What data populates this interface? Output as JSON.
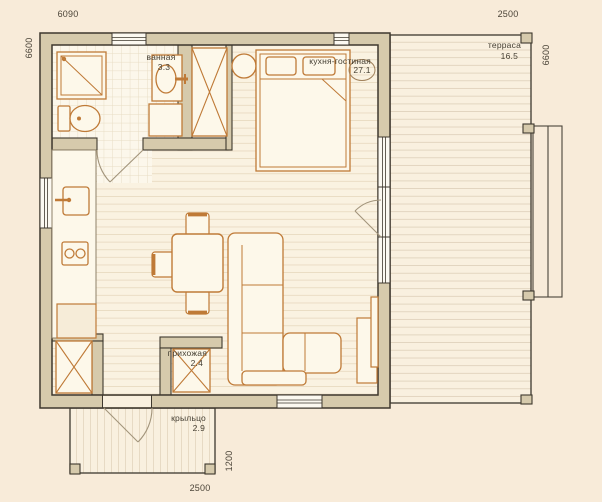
{
  "plan": {
    "title": "studio-house-floor-plan",
    "dimensions": {
      "top": "6090",
      "top_right": "2500",
      "left": "6600",
      "right": "6600",
      "bottom": "2500",
      "porch_side": "1200"
    },
    "rooms": {
      "bathroom": {
        "name": "ванная",
        "area": "3.3"
      },
      "kitchen_living": {
        "name": "кухня-гостиная",
        "area": "27.1"
      },
      "terrace": {
        "name": "терраса",
        "area": "16.5"
      },
      "hallway": {
        "name": "прихожая",
        "area": "2.4"
      },
      "porch": {
        "name": "крыльцо",
        "area": "2.9"
      }
    },
    "colors": {
      "background": "#f8ebd9",
      "floor": "#faf2e1",
      "wall_fill": "#d6caac",
      "wall_outline": "#3e382e",
      "furniture_stroke": "#bf7a37",
      "text": "#453f33"
    }
  }
}
